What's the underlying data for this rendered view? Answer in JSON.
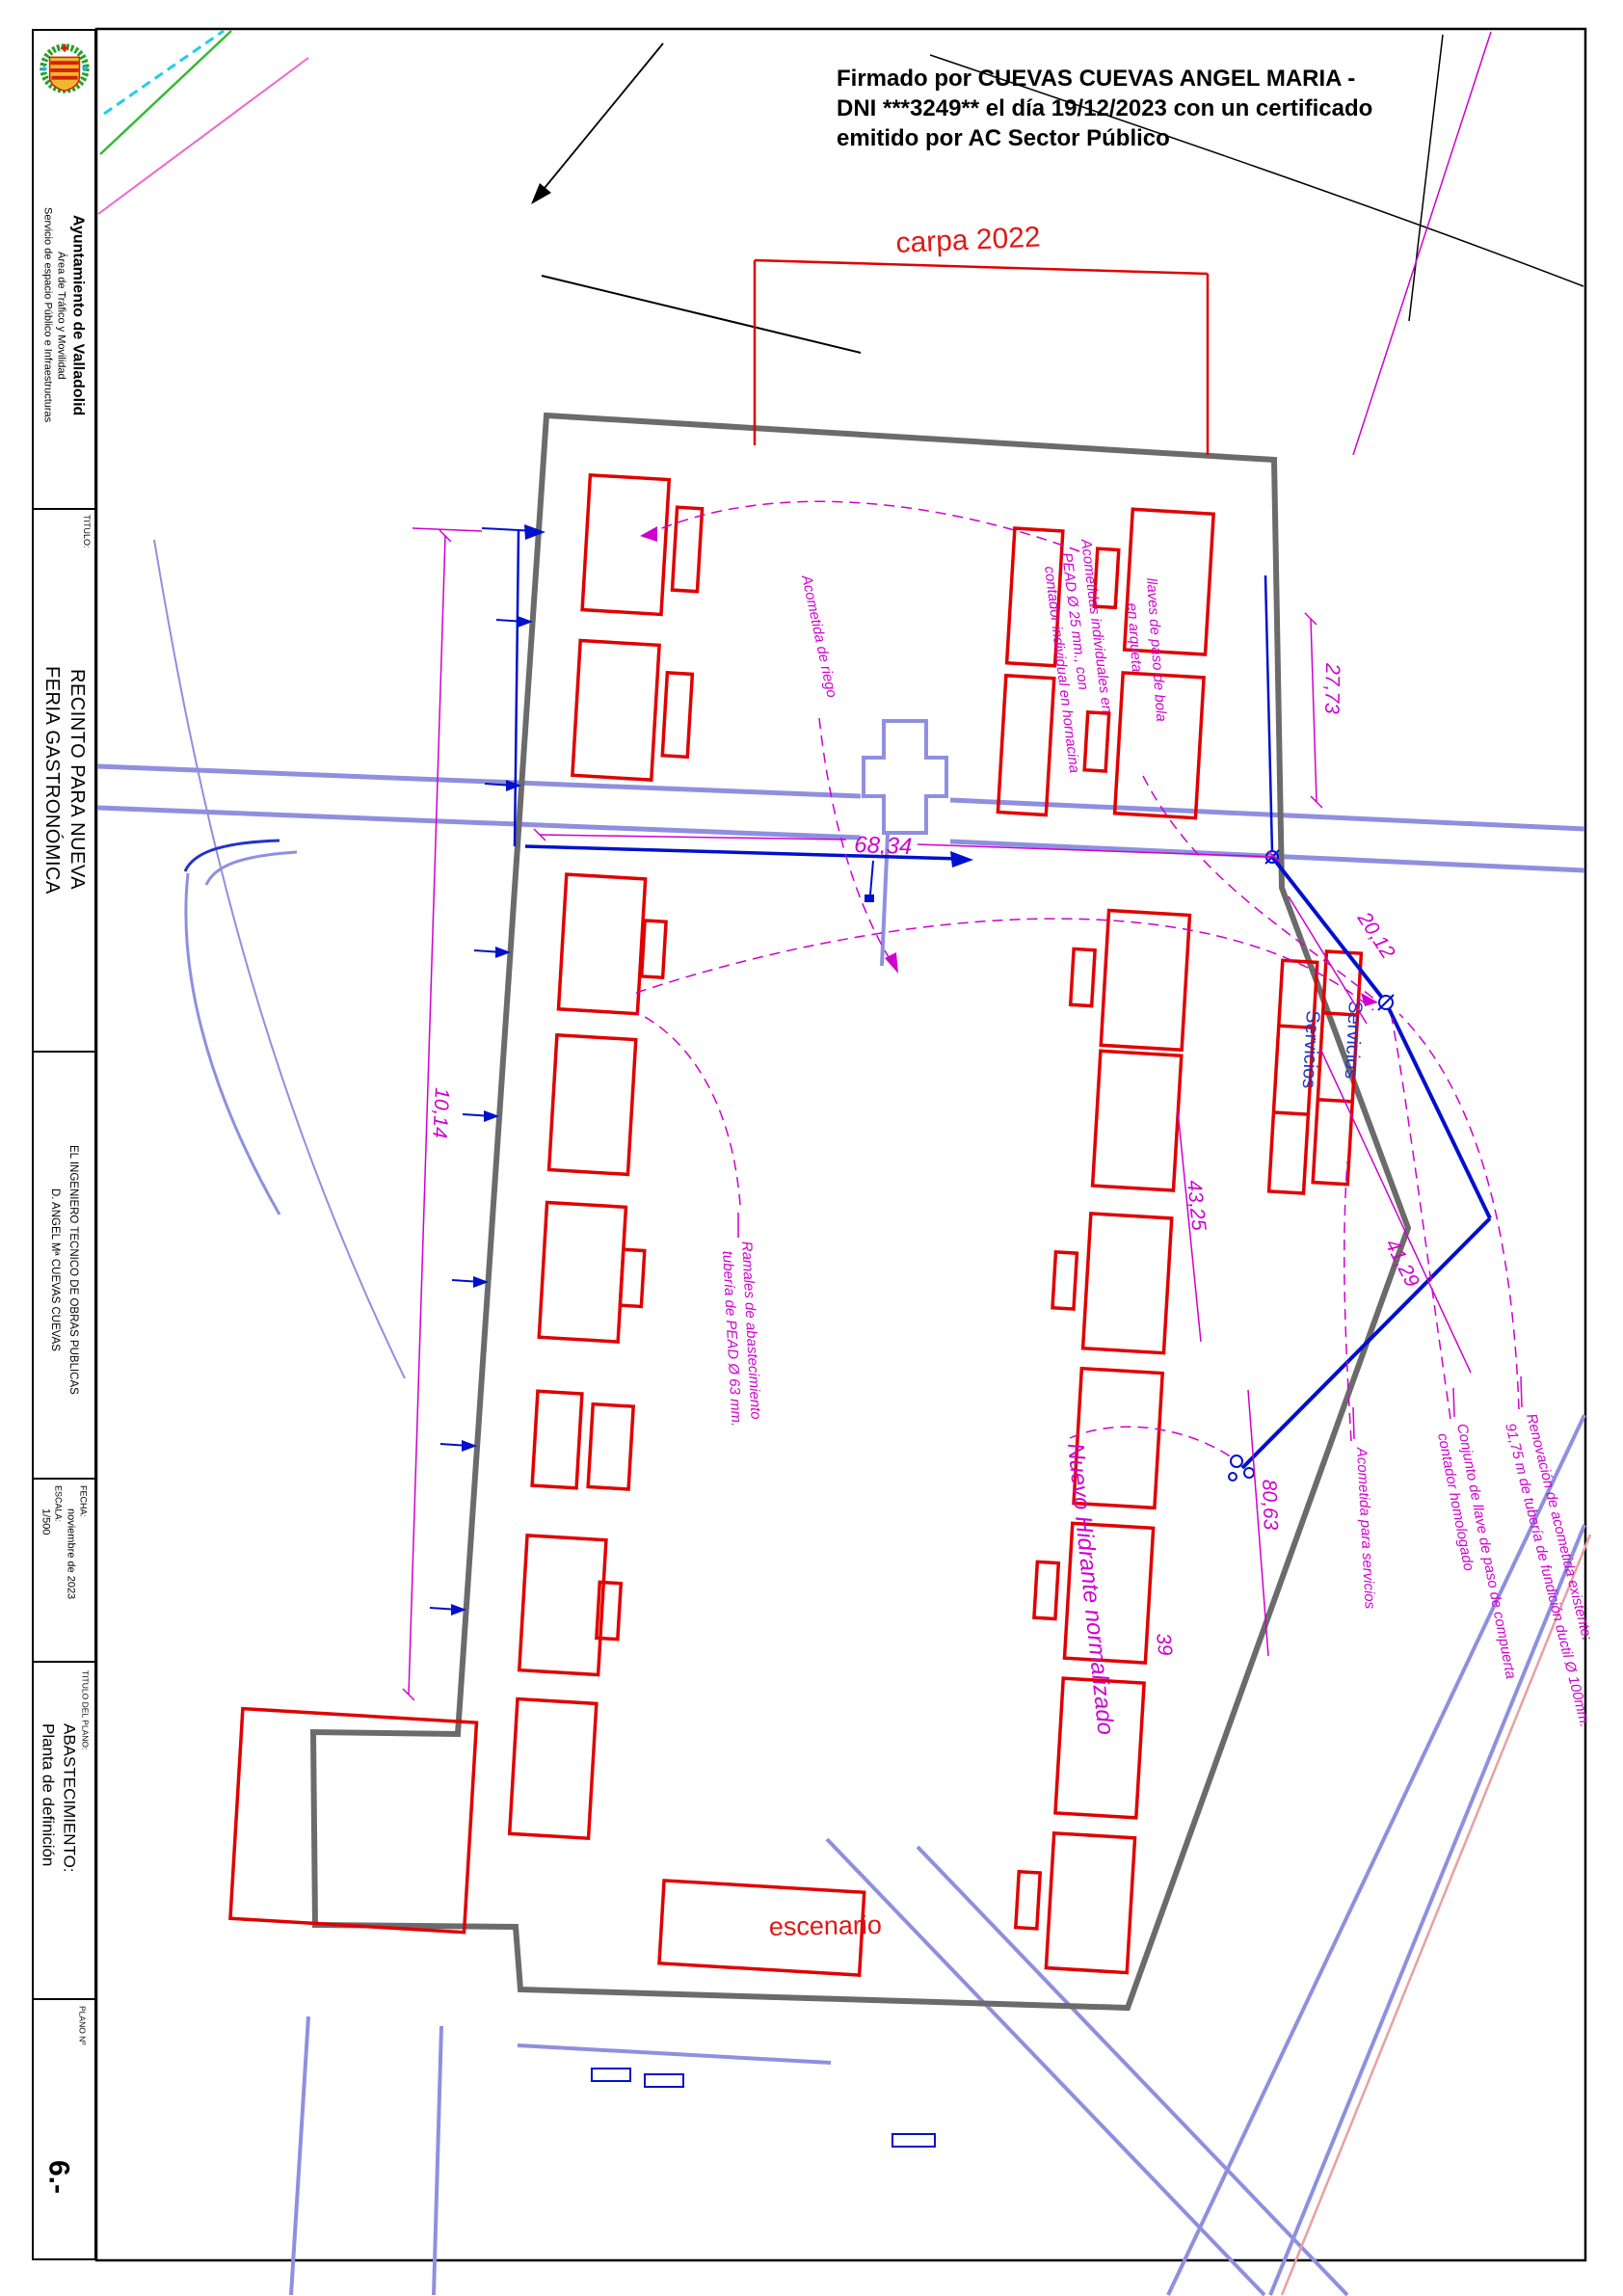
{
  "titleblock": {
    "org": {
      "line1": "Ayuntamiento de Valladolid",
      "line2": "Área de Tráfico y Movilidad",
      "line3": "Servicio de espacio Público e Infraestructuras"
    },
    "titulo": {
      "label": "TITULO:",
      "line1": "RECINTO PARA NUEVA",
      "line2": "FERIA GASTRONÓMICA"
    },
    "engineer": {
      "line1": "EL INGENIERO TECNICO DE OBRAS PUBLICAS",
      "line2": "D. ANGEL Mª CUEVAS CUEVAS"
    },
    "meta": {
      "fecha_label": "FECHA:",
      "fecha_value": "noviembre de 2023",
      "escala_label": "ESCALA:",
      "escala_value": "1/500"
    },
    "plano": {
      "label": "TITULO DEL PLANO:",
      "line1": "ABASTECIMIENTO:",
      "line2": "Planta de definición"
    },
    "num": {
      "label": "PLANO Nº",
      "value": "6.-"
    }
  },
  "signature": {
    "line1": "Firmado por CUEVAS CUEVAS ANGEL MARIA -",
    "line2": "DNI ***3249** el día 19/12/2023 con un certificado",
    "line3": "emitido por AC Sector Público"
  },
  "plan": {
    "carpa_label": "carpa 2022",
    "escenario_label": "escenario",
    "servicios_label_1": "Servicios",
    "servicios_label_2": "Servicios",
    "hidrante_label": "Nuevo Hidrante normalizado"
  },
  "annotations": {
    "acometida_riego": "Acometida de riego",
    "acometidas_individuales": [
      "Acometidas individuales en",
      "PEAD Ø 25 mm., con",
      "contador individual en hornacina"
    ],
    "llaves": [
      "llaves de paso de bola",
      "en arqueta"
    ],
    "ramales": [
      "Ramales de abastecimiento",
      "tubería de PEAD Ø 63 mm."
    ],
    "acometida_servicios": "Acometida para servicios",
    "conjunto": [
      "Conjunto de llave de paso de compuerta",
      "contador homologado"
    ],
    "renovacion": [
      "Renovación de acometida existente:",
      "91,75 m de tubería de fundición ductil Ø 100mm."
    ]
  },
  "dimensions": {
    "d68": "68,34",
    "d27": "27,73",
    "d20": "20,12",
    "d10": "10,14",
    "d43": "43,25",
    "d41": "41,29",
    "d80": "80,63",
    "d39": "39"
  },
  "colors": {
    "magenta": "#cf00cf",
    "red": "#e10000",
    "pipe_blue": "#0010cc",
    "street_periwinkle": "#8f8fe0",
    "recinto_gray": "#6b6b6b"
  }
}
